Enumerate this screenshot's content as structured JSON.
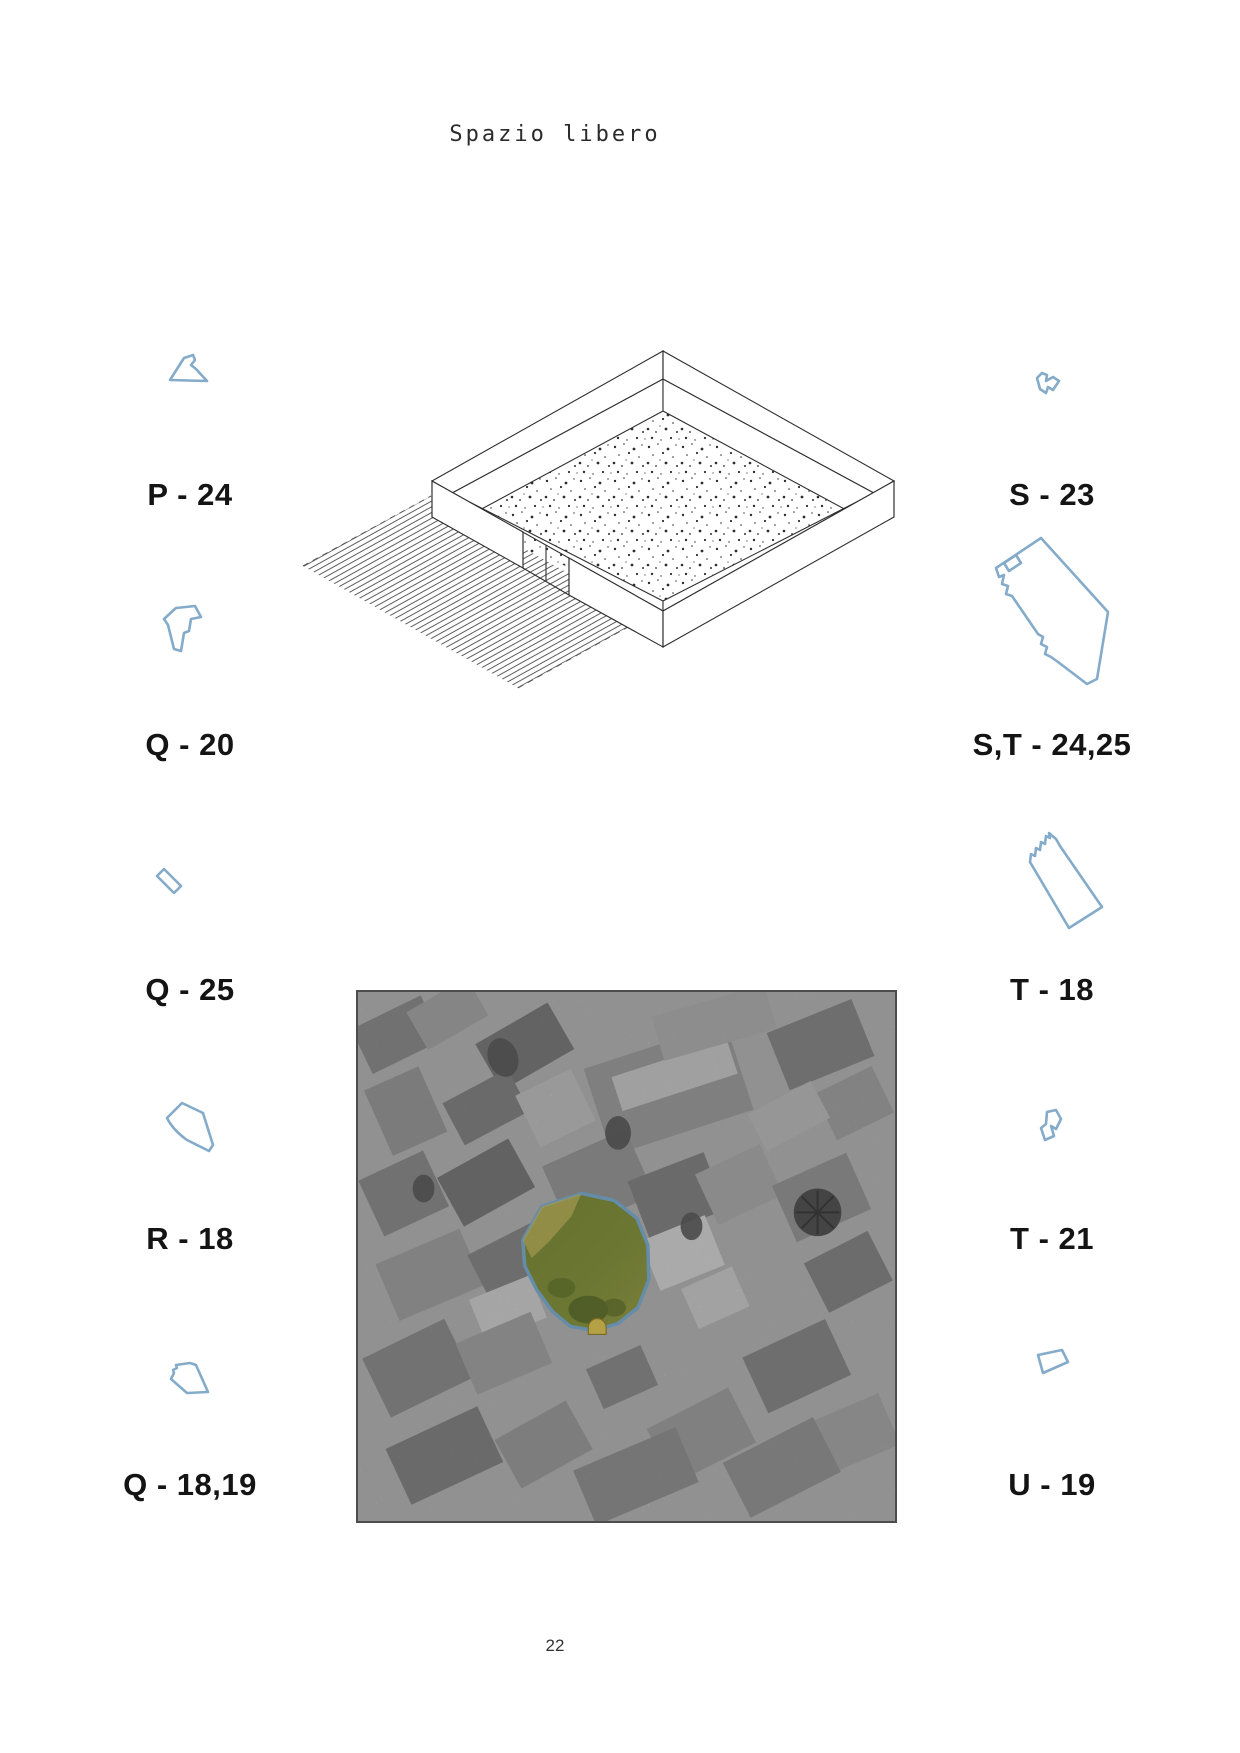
{
  "page": {
    "title": "Spazio libero",
    "page_number": "22"
  },
  "parcels": {
    "left": [
      {
        "id": "P-24",
        "label": "P - 24"
      },
      {
        "id": "Q-20",
        "label": "Q - 20"
      },
      {
        "id": "Q-25",
        "label": "Q - 25"
      },
      {
        "id": "R-18",
        "label": "R - 18"
      },
      {
        "id": "Q-18-19",
        "label": "Q - 18,19"
      }
    ],
    "right": [
      {
        "id": "S-23",
        "label": "S - 23"
      },
      {
        "id": "ST-24-25",
        "label": "S,T - 24,25"
      },
      {
        "id": "T-18",
        "label": "T - 18"
      },
      {
        "id": "T-21",
        "label": "T - 21"
      },
      {
        "id": "U-19",
        "label": "U - 19"
      }
    ]
  },
  "colors": {
    "parcel_outline": "#84abc9",
    "label_text": "#141414",
    "highlight_outline": "#7fb2d6",
    "highlight_fill": "#87963f",
    "highlight_accent": "#d9c457"
  }
}
